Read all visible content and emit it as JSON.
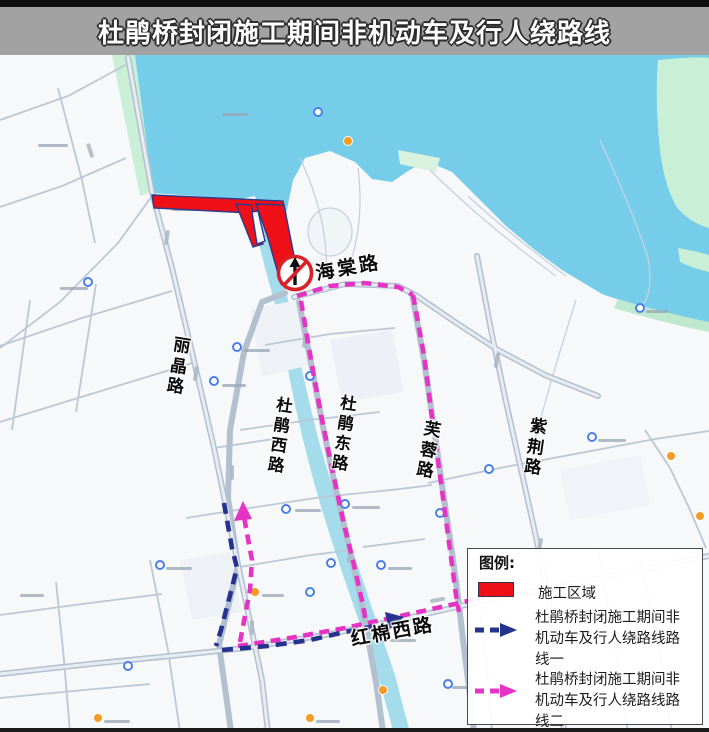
{
  "header": {
    "title": "杜鹃桥封闭施工期间非机动车及行人绕路线"
  },
  "legend": {
    "heading": "图例:",
    "construction": {
      "label": "施工区域",
      "color": "#ee1016"
    },
    "route1": {
      "color": "#25328e",
      "lines": [
        "杜鹃桥封闭施工期间非",
        "机动车及行人绕路线路",
        "线一"
      ]
    },
    "route2": {
      "color": "#e534c4",
      "lines": [
        "杜鹃桥封闭施工期间非",
        "机动车及行人绕路线路",
        "线二"
      ]
    }
  },
  "map": {
    "road_labels": [
      {
        "id": "haitang-road",
        "text": "海棠路"
      },
      {
        "id": "lijing-road",
        "text": "丽晶路"
      },
      {
        "id": "dujuan-west-road",
        "text": "杜鹃西路"
      },
      {
        "id": "dujuan-east-road",
        "text": "杜鹃东路"
      },
      {
        "id": "furong-road",
        "text": "芙蓉路"
      },
      {
        "id": "zijing-road",
        "text": "紫荆路"
      },
      {
        "id": "hongmian-west-road",
        "text": "红棉西路"
      }
    ],
    "colors": {
      "lake": "#76cde9",
      "canal": "#a4dcec",
      "park": "#c9efd6",
      "construction": "#ee1016",
      "route1": "#25328e",
      "route2": "#e534c4",
      "road": "#b7c4d3",
      "titlebar": "#a2a2a2"
    }
  }
}
